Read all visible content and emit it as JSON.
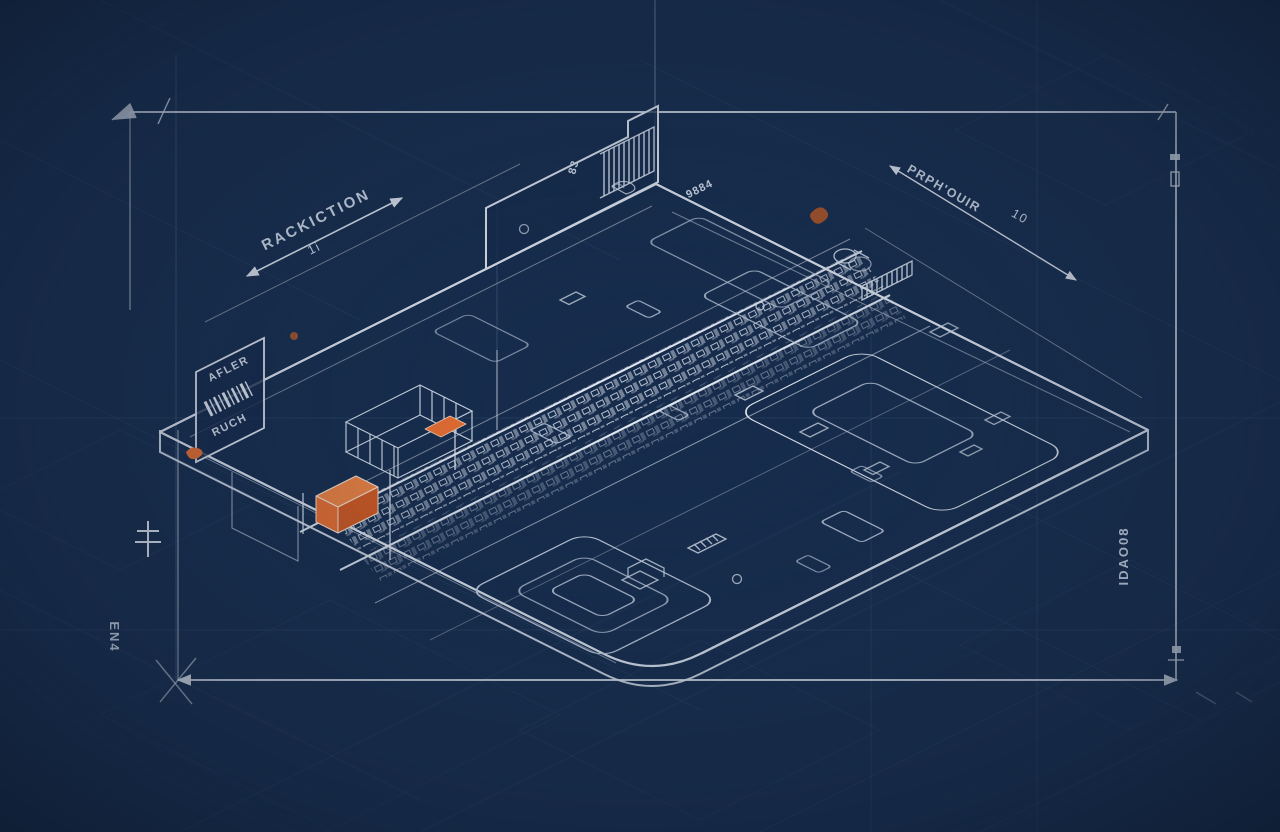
{
  "title": "Isometric circuit-board blueprint technical drawing",
  "colors": {
    "background": "#172C4C",
    "background_edge": "#0D1A2E",
    "line_bright": "#E9EEF6",
    "line_mid": "#9FB2CE",
    "line_faint": "#3A5478",
    "text": "#DBE4F1",
    "accent_orange": "#F2702E",
    "accent_orange_light": "#F6853F",
    "accent_orange_dark": "#D95A1D",
    "accent_orange_scribble": "#C05A20"
  },
  "labels": {
    "dim_top_left": {
      "text": "RACKICTION",
      "sub": "1i"
    },
    "dim_top_right": {
      "text": "PRPH'OUIR",
      "value": "10"
    },
    "panel_left": {
      "line1": "AFLER",
      "line2": "RUCH"
    },
    "marks": {
      "top_small": "83",
      "top_mid": "9884"
    },
    "side_left": "EN4",
    "side_right": "IDAO08"
  }
}
